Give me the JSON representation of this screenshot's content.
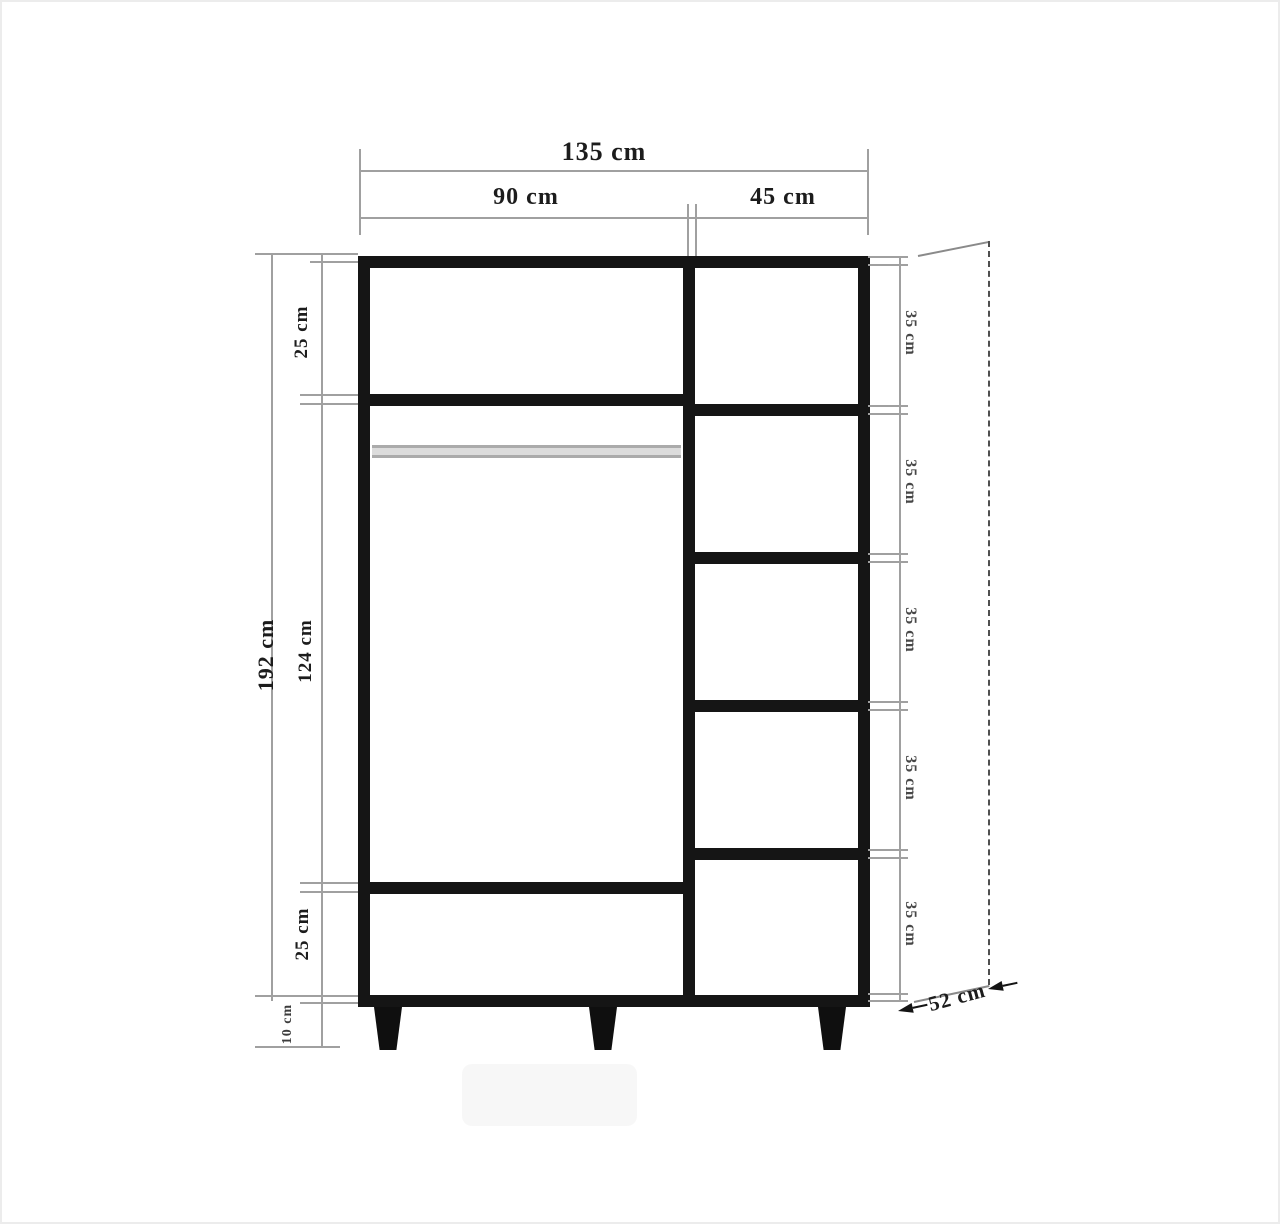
{
  "diagram": {
    "dimensions": {
      "total_width": "135 cm",
      "left_section_width": "90 cm",
      "right_section_width": "45 cm",
      "total_height": "192 cm",
      "left_top_section": "25 cm",
      "left_middle_section": "124 cm",
      "left_bottom_section": "25 cm",
      "leg_height": "10 cm",
      "right_shelves": [
        "35 cm",
        "35 cm",
        "35 cm",
        "35 cm",
        "35 cm"
      ],
      "depth": "52 cm"
    },
    "colors": {
      "frame": "#151515",
      "dimension_line": "#a0a0a0",
      "dashed_depth_line": "#4f4f4f",
      "rail": "#dcdcdc",
      "text": "#1c1c1c",
      "background": "#ffffff"
    }
  }
}
